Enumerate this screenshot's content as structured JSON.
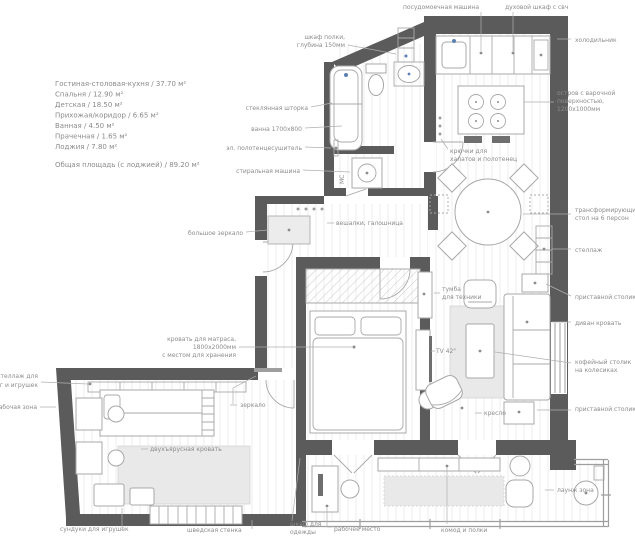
{
  "legend": {
    "items": [
      "Гостиная-столовая-кухня / 37.70 м²",
      "Спальня / 12.90 м²",
      "Детская / 18.50 м²",
      "Прихожая/коридор / 6.65 м²",
      "Ванная / 4.50 м²",
      "Прачечная / 1.65 м²",
      "Лоджия / 7.80 м²"
    ],
    "total": "Общая площадь (с лоджией) / 89.20 м²"
  },
  "labels": {
    "dishwasher": "посудомоечная машина",
    "oven": "духовой шкаф с свч",
    "fridge": "холодильник",
    "shelf_cabinet": [
      "шкаф полки,",
      "глубина 150мм"
    ],
    "glass_screen": "стеклянная шторка",
    "bath": "ванна 1700х800",
    "towel_dryer": "эл. полотенцесушитель",
    "washer": "стиральная машина",
    "washer_mark": "МС",
    "big_mirror": "большое зеркало",
    "hangers": "вешалки, галошница",
    "hooks": [
      "крючки для",
      "халатов и полотенец"
    ],
    "island": [
      "остров с варочной",
      "поверхностью,",
      "1200х1000мм"
    ],
    "table": [
      "трансформирующийся",
      "стол на 6 персон"
    ],
    "rack": "стеллаж",
    "side_table_top": "приставной столик",
    "sofa": "диван кровать",
    "coffee_table": [
      "кофейный столик",
      "на колесиках"
    ],
    "side_table_bottom": "приставной столик",
    "lounge": "лаунж зона",
    "tv_stand": [
      "тумба",
      "для техники"
    ],
    "tv": "TV 42\"",
    "armchair": "кресло",
    "bed": [
      "кровать для матраса,",
      "1800х2000мм",
      "с местом для хранения"
    ],
    "mirror": "зеркало",
    "bunk_bed": "двухъярусная кровать",
    "book_rack": [
      "стеллаж для",
      "книг и игрушек"
    ],
    "work_area": "рабочая зона",
    "toy_chests": "сундуки для игрушек",
    "wall_bars": "шведская стенка",
    "wardrobe": [
      "шкаф для",
      "одежды"
    ],
    "workplace": "рабочее место",
    "dresser": "комод и полки"
  },
  "colors": {
    "wall_dark": "#5b5b5b",
    "wall_light": "#9e9e9e",
    "furniture_line": "#a8a8a8",
    "label_text": "#8c8c8c",
    "floor_stripe": "#ededed",
    "rug": "#e9e9e9",
    "accent_blue": "#5b7fb4",
    "dark_fill": "#6e6e6e"
  }
}
